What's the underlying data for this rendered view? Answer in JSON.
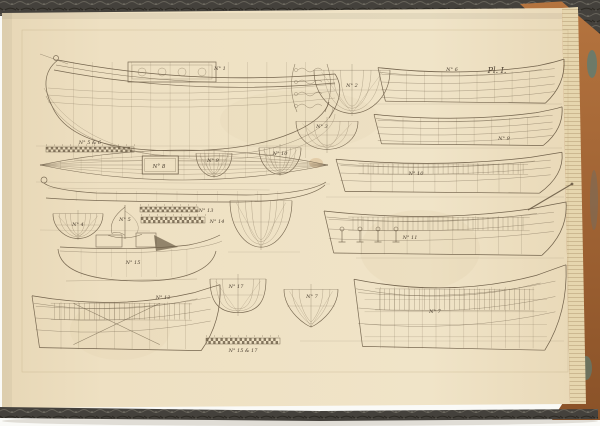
{
  "scene": {
    "background": "#fafaf7",
    "shadow": "#cfcabf",
    "page_color": "#eee0c2",
    "page_edge_color": "#e3d2a9",
    "ink_color": "#6b5c46",
    "label_color": "#4f4334",
    "cover_marble_dark": "#413e38",
    "cover_marble_light": "#6f6b62",
    "leather_color": "#aa6c3d",
    "marble_teal": "#5c7d74"
  },
  "plate": {
    "plate_label": "Pl. I.",
    "construction_lines": [
      [
        36,
        146,
        334,
        146
      ],
      [
        36,
        182,
        330,
        184
      ],
      [
        374,
        104,
        562,
        104
      ],
      [
        338,
        148,
        562,
        148
      ],
      [
        326,
        197,
        564,
        197
      ],
      [
        356,
        258,
        564,
        258
      ],
      [
        300,
        341,
        564,
        341
      ],
      [
        40,
        230,
        150,
        231
      ],
      [
        228,
        252,
        300,
        252
      ]
    ],
    "drawings": [
      {
        "id": "no1-sheer-profile",
        "type": "bigProfile",
        "x": 38,
        "y": 52,
        "w": 305,
        "h": 112,
        "label": "N° 1",
        "lx": 220,
        "ly": 70
      },
      {
        "id": "no5-6-scale",
        "type": "ruler",
        "x": 46,
        "y": 147,
        "w": 88,
        "h": 5,
        "label": "N° 5 & 6",
        "lx": 90,
        "ly": 144
      },
      {
        "id": "stern-ornament",
        "type": "ornate",
        "x": 289,
        "y": 62,
        "w": 44,
        "h": 52
      },
      {
        "id": "no2-body-plan",
        "type": "body",
        "shape": "round",
        "x": 314,
        "y": 64,
        "w": 76,
        "h": 52,
        "label": "N° 2",
        "lx": 352,
        "ly": 87
      },
      {
        "id": "no3-body-plan",
        "type": "body",
        "shape": "wide",
        "x": 296,
        "y": 117,
        "w": 62,
        "h": 36,
        "label": "N° 3",
        "lx": 322,
        "ly": 128
      },
      {
        "id": "no8-half-breadth-plan",
        "type": "lens",
        "x": 40,
        "y": 150,
        "w": 288,
        "h": 30,
        "box": true,
        "label": "N° 8",
        "lx": 159,
        "ly": 168
      },
      {
        "id": "long-boat-profile",
        "type": "gondola",
        "x": 36,
        "y": 176,
        "w": 292,
        "h": 30
      },
      {
        "id": "no9-body-plan",
        "type": "body",
        "shape": "round",
        "x": 196,
        "y": 150,
        "w": 36,
        "h": 28,
        "label": "N° 9",
        "lx": 213,
        "ly": 162
      },
      {
        "id": "no10-body-plan",
        "type": "body",
        "shape": "round",
        "x": 259,
        "y": 144,
        "w": 42,
        "h": 32,
        "label": "N° 10",
        "lx": 280,
        "ly": 155
      },
      {
        "id": "no13-scale",
        "type": "ruler",
        "x": 140,
        "y": 207,
        "w": 58,
        "h": 5,
        "label": "N° 13",
        "lx": 206,
        "ly": 212
      },
      {
        "id": "no14-scale",
        "type": "ruler",
        "x": 141,
        "y": 217,
        "w": 64,
        "h": 6,
        "label": "N° 14",
        "lx": 217,
        "ly": 223
      },
      {
        "id": "no4-body-plan",
        "type": "body",
        "shape": "round",
        "x": 53,
        "y": 210,
        "w": 50,
        "h": 30,
        "label": "N° 4",
        "lx": 78,
        "ly": 226
      },
      {
        "id": "no5-sail-section",
        "type": "sail",
        "x": 106,
        "y": 203,
        "w": 38,
        "h": 38,
        "label": "N° 5",
        "lx": 125,
        "ly": 221
      },
      {
        "id": "center-body-plan",
        "type": "body",
        "shape": "round",
        "x": 230,
        "y": 194,
        "w": 62,
        "h": 56
      },
      {
        "id": "no15-hull-profile",
        "type": "deckboat",
        "x": 56,
        "y": 233,
        "w": 166,
        "h": 52,
        "label": "N° 15",
        "lx": 133,
        "ly": 264
      },
      {
        "id": "no12-hull-profile",
        "type": "hull",
        "framed": true,
        "braces": true,
        "x": 32,
        "y": 281,
        "w": 188,
        "h": 74,
        "label": "N° 12",
        "lx": 163,
        "ly": 299
      },
      {
        "id": "no17-body-plan",
        "type": "body",
        "shape": "flat",
        "x": 210,
        "y": 274,
        "w": 56,
        "h": 42,
        "label": "N° 17",
        "lx": 236,
        "ly": 288
      },
      {
        "id": "no7-body-plan",
        "type": "body",
        "shape": "vee",
        "x": 284,
        "y": 284,
        "w": 54,
        "h": 44,
        "label": "N° 7",
        "lx": 312,
        "ly": 298
      },
      {
        "id": "bottom-scale",
        "type": "ruler",
        "x": 206,
        "y": 338,
        "w": 74,
        "h": 6,
        "label": "N° 15 & 17",
        "lx": 243,
        "ly": 352
      },
      {
        "id": "no6-hull-profile",
        "type": "hull",
        "open": true,
        "x": 378,
        "y": 58,
        "w": 186,
        "h": 48,
        "label": "N° 6",
        "lx": 452,
        "ly": 71
      },
      {
        "id": "no9-hull-profile",
        "type": "hull",
        "open": true,
        "x": 374,
        "y": 106,
        "w": 188,
        "h": 42,
        "label": "N° 9",
        "lx": 504,
        "ly": 140
      },
      {
        "id": "no10-hull-profile",
        "type": "hull",
        "framed": true,
        "x": 336,
        "y": 150,
        "w": 226,
        "h": 46,
        "label": "N° 10",
        "lx": 416,
        "ly": 175
      },
      {
        "id": "no11-hull-profile",
        "type": "hull",
        "framed": true,
        "x": 324,
        "y": 199,
        "w": 242,
        "h": 60,
        "label": "N° 11",
        "lx": 410,
        "ly": 239
      },
      {
        "id": "stern-spar",
        "type": "spar",
        "x": 528,
        "y": 184,
        "w": 44,
        "h": 26
      },
      {
        "id": "deck-capstans",
        "type": "capstans",
        "x": 334,
        "y": 226,
        "w": 72,
        "h": 16
      },
      {
        "id": "no7-hull-profile",
        "type": "hull",
        "framed": true,
        "grid": true,
        "x": 354,
        "y": 260,
        "w": 212,
        "h": 96,
        "label": "N° 7",
        "lx": 435,
        "ly": 313
      }
    ]
  }
}
